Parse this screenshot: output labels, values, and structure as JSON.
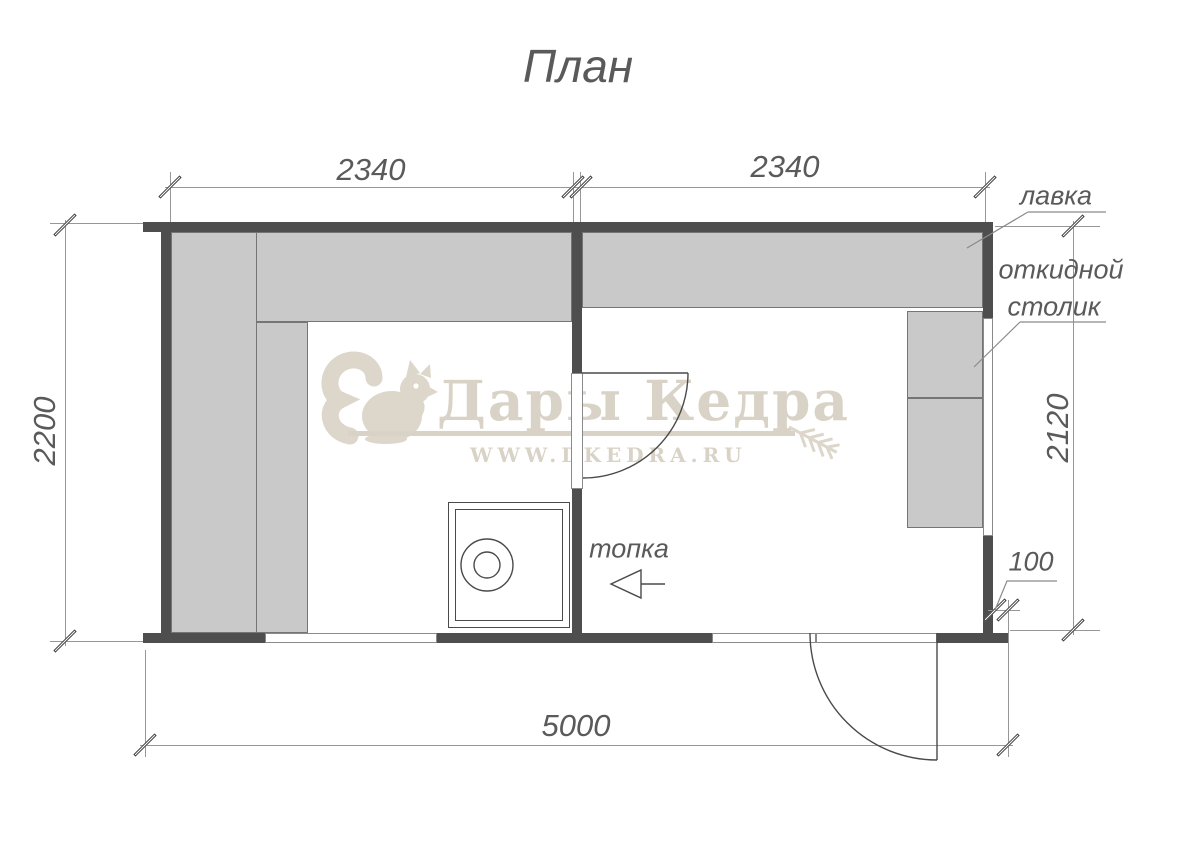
{
  "title": "План",
  "dimensions": {
    "top_left_span": "2340",
    "top_right_span": "2340",
    "left_height": "2200",
    "right_height": "2120",
    "wall_offset": "100",
    "total_width": "5000"
  },
  "labels": {
    "bench": "лавка",
    "folding_table_line1": "откидной",
    "folding_table_line2": "столик",
    "firebox": "топка"
  },
  "watermark": {
    "brand": "Дары Кедра",
    "website": "WWW.DKEDRA.RU"
  },
  "colors": {
    "wall": "#4e4e4e",
    "bench_fill": "#c9c9c9",
    "bench_outline": "#757575",
    "dimension_line": "#979797",
    "technical_text": "#5a5a5a",
    "watermark": "#d9d2c6"
  }
}
